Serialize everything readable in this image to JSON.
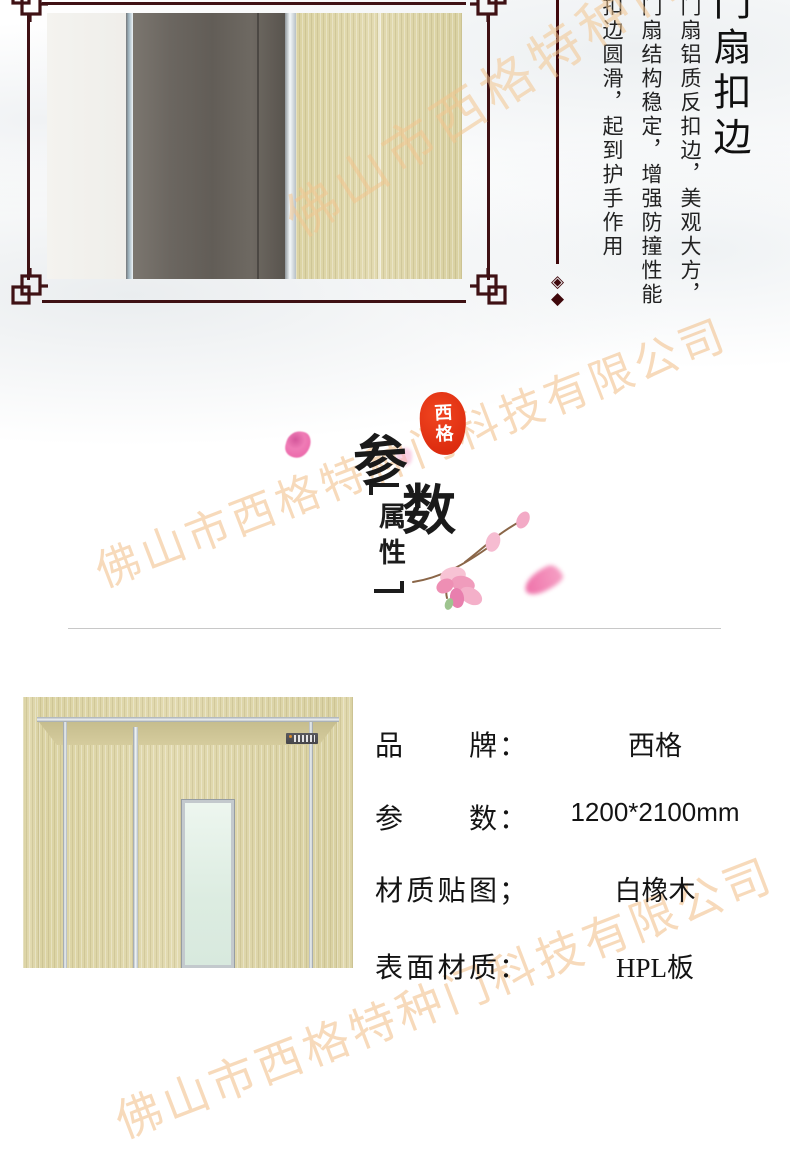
{
  "watermark": {
    "text": "佛山市西格特种门科技有限公司",
    "color": "#f0b678"
  },
  "hero": {
    "frame_color": "#3f1114",
    "title_vertical": "门扇扣边",
    "caption_columns": [
      "门扇铝质反扣边，美观大方，",
      "门扇结构稳定，增强防撞性能",
      "扣边圆滑，起到护手作用"
    ],
    "diamond_outline": "◈",
    "diamond_solid": "◆",
    "photo_colors": {
      "white_panel": "#f3f2ee",
      "dark_gray_trim": "#666159",
      "silver_edge": "#e8eef1",
      "wood_veneer": "#ded6a8"
    }
  },
  "section_header": {
    "seal_text": "西格",
    "seal_color": "#e5330f",
    "char_primary": "参",
    "char_secondary": "数",
    "bracket_label": "属性",
    "petal_color": "#ef6fae"
  },
  "product": {
    "specs": [
      {
        "label": "品牌",
        "colon": "：",
        "value": "西格"
      },
      {
        "label": "参数",
        "colon": "：",
        "value": "1200*2100mm"
      },
      {
        "label": "材质贴图",
        "colon": "；",
        "value": "白橡木"
      },
      {
        "label": "表面材质",
        "colon": "：",
        "value": "HPL板"
      }
    ]
  }
}
